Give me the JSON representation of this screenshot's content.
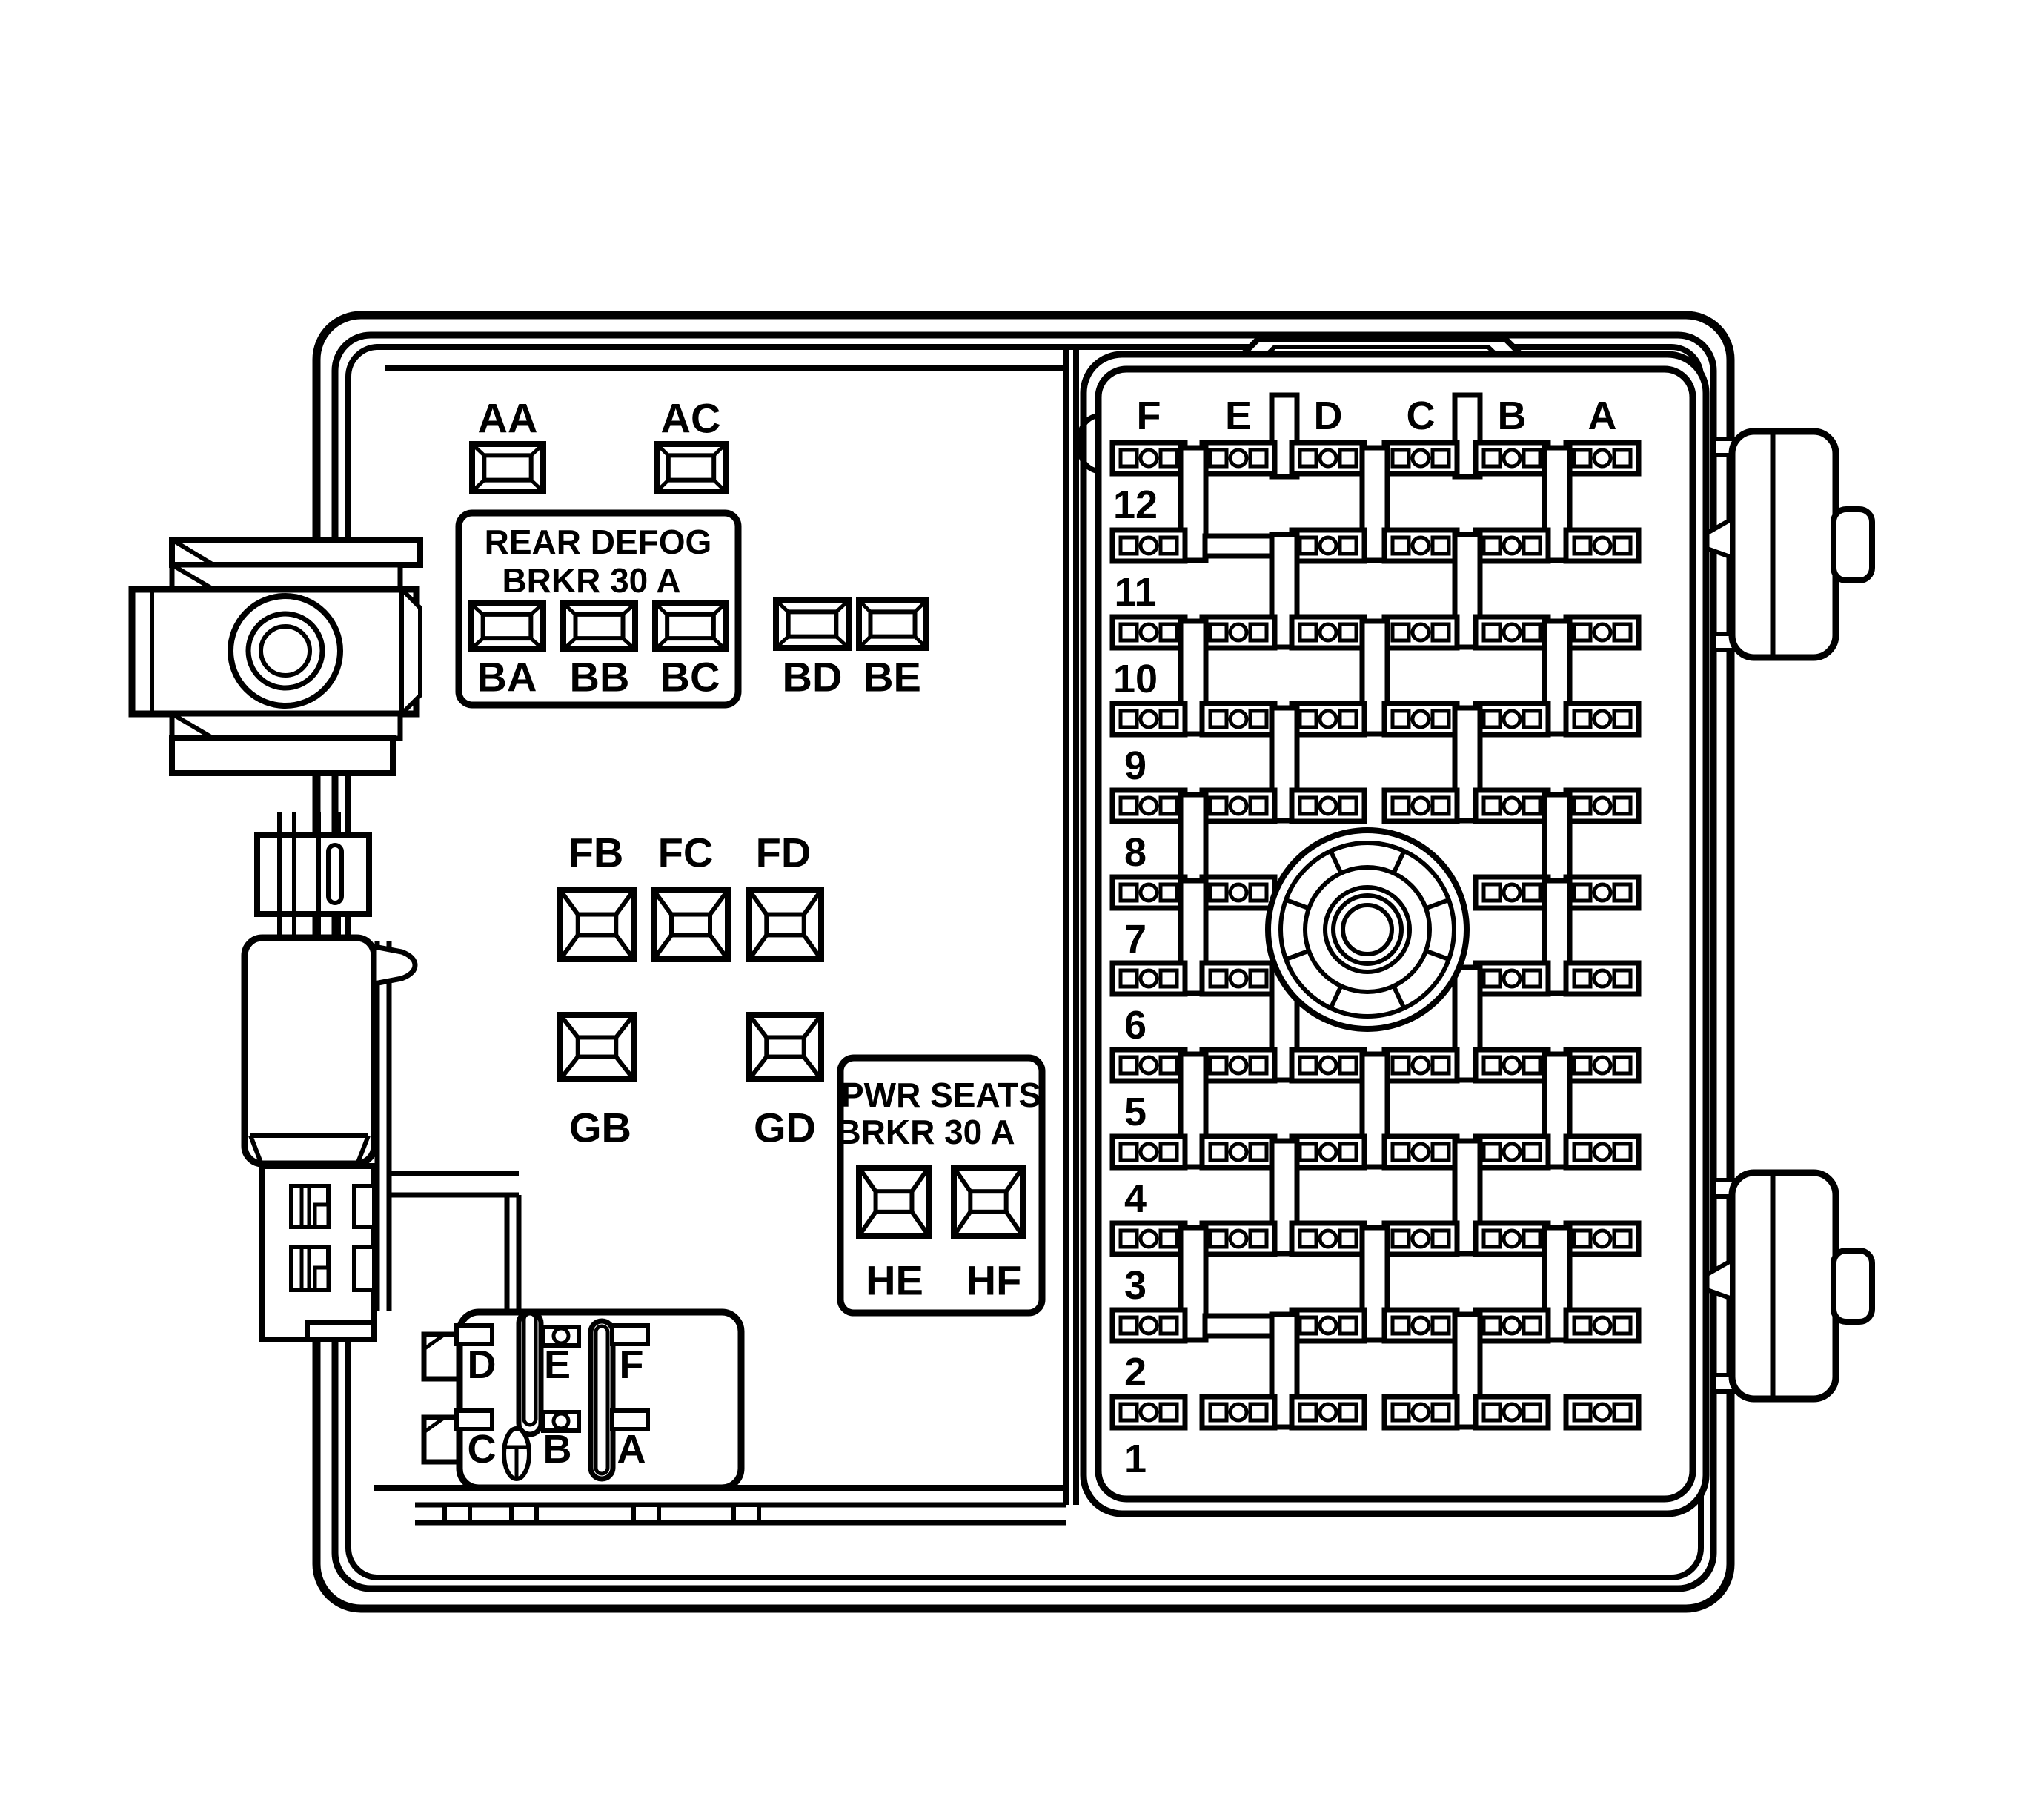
{
  "colors": {
    "ink": "#000000",
    "background": "#ffffff"
  },
  "diagram": {
    "top_relays": [
      "AA",
      "AC"
    ],
    "rear_defog": {
      "line1": "REAR DEFOG",
      "line2": "BRKR 30 A",
      "relays": [
        "BA",
        "BB",
        "BC"
      ]
    },
    "aux_relays": [
      "BD",
      "BE"
    ],
    "relay_row_f": [
      "FB",
      "FC",
      "FD"
    ],
    "relay_row_g": [
      "GB",
      "GD"
    ],
    "pwr_seats": {
      "line1": "PWR SEATS",
      "line2": "BRKR 30 A",
      "relays": [
        "HE",
        "HF"
      ]
    },
    "connector": {
      "top": [
        "D",
        "E",
        "F"
      ],
      "bottom": [
        "C",
        "B",
        "A"
      ]
    },
    "fuse_panel": {
      "columns": [
        "F",
        "E",
        "D",
        "C",
        "B",
        "A"
      ],
      "header_slots": [
        "ED",
        "CB"
      ],
      "rows": [
        {
          "label": "12",
          "fuses": [
            "F",
            "E",
            "D",
            "C",
            "B",
            "A"
          ],
          "blanks": [],
          "talls": []
        },
        {
          "label": "11",
          "fuses": [
            "F",
            "D",
            "C",
            "B",
            "A"
          ],
          "blanks": [
            "E"
          ],
          "talls": [
            "FE",
            "DC",
            "BA"
          ]
        },
        {
          "label": "10",
          "fuses": [
            "F",
            "E",
            "D",
            "C",
            "B",
            "A"
          ],
          "blanks": [],
          "talls": [
            "ED",
            "CB"
          ]
        },
        {
          "label": "9",
          "fuses": [
            "F",
            "E",
            "D",
            "C",
            "B",
            "A"
          ],
          "blanks": [],
          "talls": [
            "FE",
            "DC",
            "BA"
          ]
        },
        {
          "label": "8",
          "fuses": [
            "F",
            "E",
            "D",
            "C",
            "B",
            "A"
          ],
          "blanks": [],
          "talls": [
            "ED",
            "CB"
          ]
        },
        {
          "label": "7",
          "fuses": [
            "F",
            "E",
            "B",
            "A"
          ],
          "blanks": [],
          "talls": [
            "FE",
            "BA"
          ]
        },
        {
          "label": "6",
          "fuses": [
            "F",
            "E",
            "B",
            "A"
          ],
          "blanks": [],
          "talls": [
            "FE",
            "BA"
          ]
        },
        {
          "label": "5",
          "fuses": [
            "F",
            "E",
            "D",
            "C",
            "B",
            "A"
          ],
          "blanks": [],
          "talls": [
            "ED",
            "CB"
          ]
        },
        {
          "label": "4",
          "fuses": [
            "F",
            "E",
            "D",
            "C",
            "B",
            "A"
          ],
          "blanks": [],
          "talls": [
            "FE",
            "DC",
            "BA"
          ]
        },
        {
          "label": "3",
          "fuses": [
            "F",
            "E",
            "D",
            "C",
            "B",
            "A"
          ],
          "blanks": [],
          "talls": [
            "ED",
            "CB"
          ]
        },
        {
          "label": "2",
          "fuses": [
            "F",
            "D",
            "C",
            "B",
            "A"
          ],
          "blanks": [
            "E"
          ],
          "talls": [
            "FE",
            "DC",
            "BA"
          ]
        },
        {
          "label": "1",
          "fuses": [
            "F",
            "E",
            "D",
            "C",
            "B",
            "A"
          ],
          "blanks": [],
          "talls": [
            "ED",
            "CB"
          ]
        }
      ]
    }
  }
}
